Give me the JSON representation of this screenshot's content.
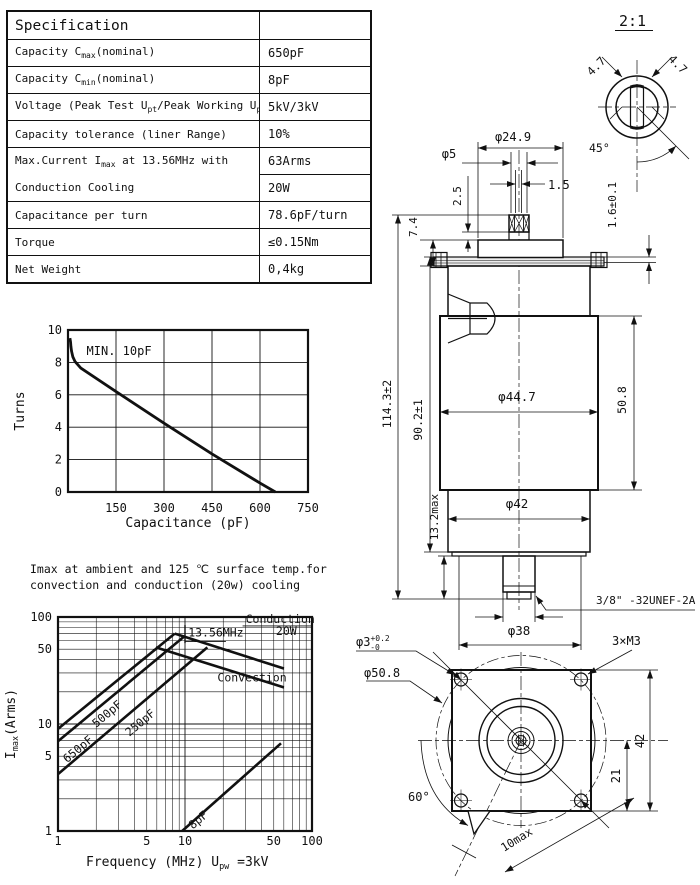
{
  "spec_table": {
    "title": "Specification",
    "rows": [
      {
        "label": [
          {
            "t": "Capacity C"
          },
          {
            "t": "max",
            "sub": true
          },
          {
            "t": "(nominal)"
          }
        ],
        "value": "650pF"
      },
      {
        "label": [
          {
            "t": "Capacity C"
          },
          {
            "t": "min",
            "sub": true
          },
          {
            "t": "(nominal)"
          }
        ],
        "value": "8pF"
      },
      {
        "label": [
          {
            "t": "Voltage (Peak Test U"
          },
          {
            "t": "pt",
            "sub": true
          },
          {
            "t": "/Peak Working U"
          },
          {
            "t": "pw",
            "sub": true
          },
          {
            "t": ")"
          }
        ],
        "value": "5kV/3kV"
      },
      {
        "label": [
          {
            "t": "Capacity tolerance (liner Range)"
          }
        ],
        "value": "10%"
      },
      {
        "label": [
          {
            "t": "Max.Current I"
          },
          {
            "t": "max",
            "sub": true
          },
          {
            "t": " at 13.56MHz with"
          }
        ],
        "value": "63Arms",
        "joins_next": true
      },
      {
        "label": [
          {
            "t": "Conduction Cooling"
          }
        ],
        "value": "20W",
        "joined": true
      },
      {
        "label": [
          {
            "t": "Capacitance per turn"
          }
        ],
        "value": "78.6pF/turn"
      },
      {
        "label": [
          {
            "t": "Torque"
          }
        ],
        "value": "≤0.15Nm"
      },
      {
        "label": [
          {
            "t": "Net Weight"
          }
        ],
        "value": "0,4kg"
      }
    ]
  },
  "chart_data": [
    {
      "type": "line",
      "title": "",
      "xlabel": "Capacitance (pF)",
      "ylabel": "Turns",
      "xlim": [
        0,
        750
      ],
      "ylim": [
        0,
        10
      ],
      "xticks": [
        150,
        300,
        450,
        600,
        750
      ],
      "yticks": [
        0,
        2,
        4,
        6,
        8,
        10
      ],
      "grid": true,
      "annotation": {
        "text": "MIN. 10pF",
        "x": 58,
        "y": 8.45
      },
      "series": [
        {
          "name": "turns-vs-capacitance",
          "color": "#111111",
          "points": [
            [
              6,
              9.5
            ],
            [
              8,
              9.25
            ],
            [
              9,
              9.0
            ],
            [
              11,
              8.7
            ],
            [
              15,
              8.35
            ],
            [
              22,
              8.05
            ],
            [
              40,
              7.65
            ],
            [
              150,
              6.2
            ],
            [
              300,
              4.25
            ],
            [
              450,
              2.35
            ],
            [
              600,
              0.55
            ],
            [
              648,
              0
            ]
          ]
        }
      ]
    },
    {
      "type": "line",
      "title_lines": [
        "Imax at ambient and 125 ℃ surface temp.for",
        "convection and conduction (20w) cooling"
      ],
      "xlabel_parts": [
        {
          "t": "Frequency (MHz) U"
        },
        {
          "t": "pw",
          "sub": true
        },
        {
          "t": " =3kV"
        }
      ],
      "ylabel_parts": [
        {
          "t": "I"
        },
        {
          "t": "max",
          "sub": true
        },
        {
          "t": "(Arms)"
        }
      ],
      "xscale": "log",
      "yscale": "log",
      "xlim": [
        1,
        100
      ],
      "ylim": [
        1,
        100
      ],
      "xticks": [
        1,
        5,
        10,
        50,
        100
      ],
      "yticks": [
        1,
        5,
        10,
        50,
        100
      ],
      "grid": true,
      "series": [
        {
          "name": "650pF",
          "color": "#111111",
          "points": [
            [
              1,
              9
            ],
            [
              8.3,
              70
            ]
          ]
        },
        {
          "name": "500pF",
          "color": "#111111",
          "points": [
            [
              1,
              6.9
            ],
            [
              9.9,
              66
            ]
          ]
        },
        {
          "name": "250pF",
          "color": "#111111",
          "points": [
            [
              1,
              3.4
            ],
            [
              15,
              52
            ]
          ]
        },
        {
          "name": "conduction-20W",
          "color": "#111111",
          "points": [
            [
              8.3,
              70
            ],
            [
              60,
              33
            ]
          ]
        },
        {
          "name": "convection",
          "color": "#111111",
          "points": [
            [
              5.9,
              52
            ],
            [
              60,
              22
            ]
          ]
        },
        {
          "name": "8pF",
          "color": "#111111",
          "points": [
            [
              9.5,
              1
            ],
            [
              57,
              6.6
            ]
          ]
        }
      ],
      "freq_marker": {
        "x": 10,
        "y1": 57,
        "y2": 84,
        "label": "13.56MHz",
        "label_x": 10.6,
        "label_y": 66,
        "underline_to_x": 21,
        "underline_y": 59
      },
      "labels": [
        {
          "text": "Conduction",
          "x": 30,
          "y": 88,
          "rotate": 0,
          "underline": true
        },
        {
          "text": "20W",
          "x": 52,
          "y": 68,
          "rotate": 0
        },
        {
          "text": "Convection",
          "x": 18,
          "y": 25,
          "rotate": 0
        },
        {
          "text": "650pF",
          "x": 1.18,
          "y": 4.3,
          "rotate": -40
        },
        {
          "text": "500pF",
          "x": 2.0,
          "y": 9.2,
          "rotate": -40
        },
        {
          "text": "250pF",
          "x": 3.65,
          "y": 7.6,
          "rotate": -40
        },
        {
          "text": "8pF",
          "x": 11.5,
          "y": 1.03,
          "rotate": -40
        }
      ]
    }
  ],
  "drawing": {
    "scale_label": "2:1",
    "detail_dim_left": "4.7",
    "detail_dim_right": "4.7",
    "detail_angle": "45°",
    "phi24_9": "φ24.9",
    "phi5": "φ5",
    "dim2_5": "2.5",
    "dim1_5": "1.5",
    "dim7_4": "7.4",
    "dim1_6": "1.6±0.1",
    "dim114": "114.3±2",
    "dim90": "90.2±1",
    "dim13_2": "13.2max",
    "dim50_8": "50.8",
    "phi44_7": "φ44.7",
    "phi42": "φ42",
    "phi38": "φ38",
    "thread": "3/8\" -32UNEF-2A",
    "m3": "3×M3",
    "phi3_base": "φ3",
    "phi3_sup": "+0.2",
    "phi3_sub": "-0",
    "phi50_8": "φ50.8",
    "dim42": "42",
    "dim21": "21",
    "angle60": "60°",
    "dim10": "10max"
  }
}
